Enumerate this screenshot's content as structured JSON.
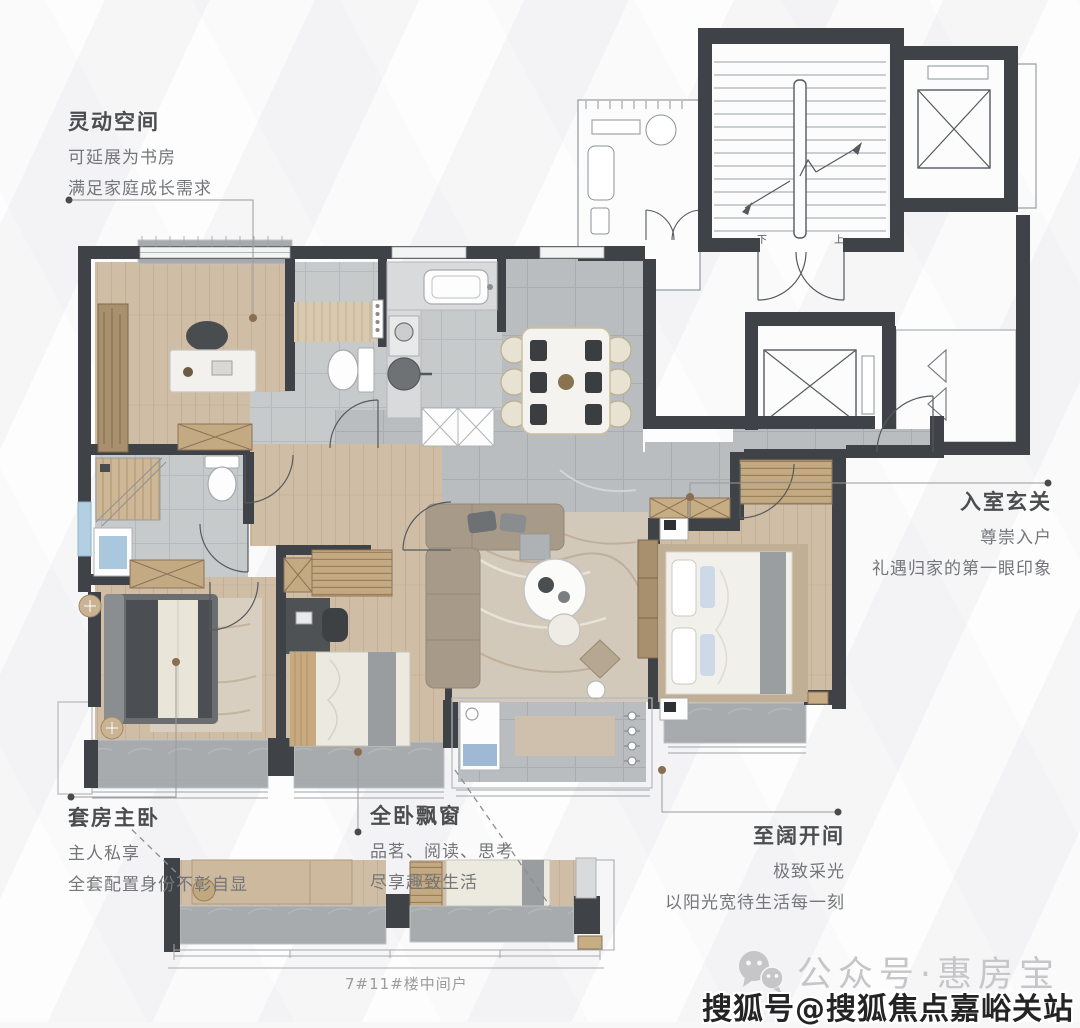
{
  "page": {
    "caption": "7#11#楼中间户"
  },
  "annotations": {
    "flex_space": {
      "title": "灵动空间",
      "lines": [
        "可延展为书房",
        "满足家庭成长需求"
      ]
    },
    "entry_foyer": {
      "title": "入室玄关",
      "lines": [
        "尊崇入户",
        "礼遇归家的第一眼印象"
      ]
    },
    "master_suite": {
      "title": "套房主卧",
      "lines": [
        "主人私享",
        "全套配置身份不彰自显"
      ]
    },
    "bay_window": {
      "title": "全卧飘窗",
      "lines": [
        "品茗、阅读、思考",
        "尽享趣致生活"
      ]
    },
    "wide_bay": {
      "title": "至阔开间",
      "lines": [
        "极致采光",
        "以阳光宽待生活每一刻"
      ]
    }
  },
  "floor_plan": {
    "stair_down_label": "下",
    "stair_up_label": "上"
  },
  "watermarks": {
    "wechat_account": "公众号·惠房宝",
    "sohu_account": "搜狐号@搜狐焦点嘉峪关站"
  },
  "icons": {
    "wechat": "wechat-icon"
  },
  "colors": {
    "wall": "#3f4347",
    "wood_floor": "#cfbda6",
    "tile_floor": "#babdbf",
    "sill": "#a8abad",
    "title_text": "#4b4d4f",
    "body_text": "#74767a",
    "leader_dot_brown": "#8a6e52",
    "leader_dot_dark": "#4a4a4a",
    "watermark_gray": "#c6c6c8",
    "watermark_dark": "#242425",
    "accent_blue": "#a9c7dd"
  }
}
